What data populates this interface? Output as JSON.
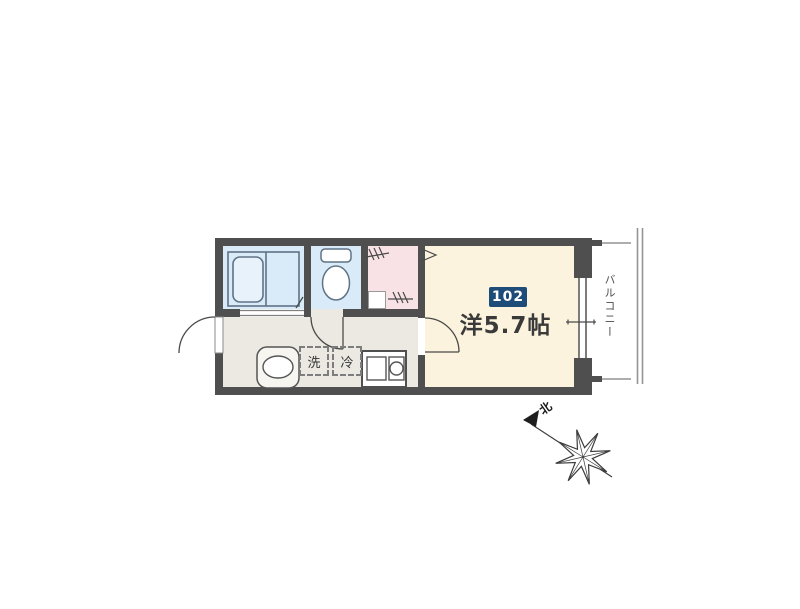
{
  "unit": {
    "number": "102",
    "size_label": "洋5.7帖"
  },
  "labels": {
    "balcony": "バルコニー",
    "washing_machine": "洗",
    "refrigerator": "冷",
    "north": "北"
  },
  "colors": {
    "wall": "#4f4f4f",
    "wet": "#d9ebf8",
    "tub": "#e8f2fb",
    "closet": "#f8e2e5",
    "hall": "#ebe9e1",
    "room": "#fcf3de",
    "badge": "#1d4c78",
    "badgeText": "#ffffff",
    "stroke": "#5f7387",
    "ink": "#3a3a3a",
    "rail": "#949494",
    "paper": "#ffffff"
  }
}
